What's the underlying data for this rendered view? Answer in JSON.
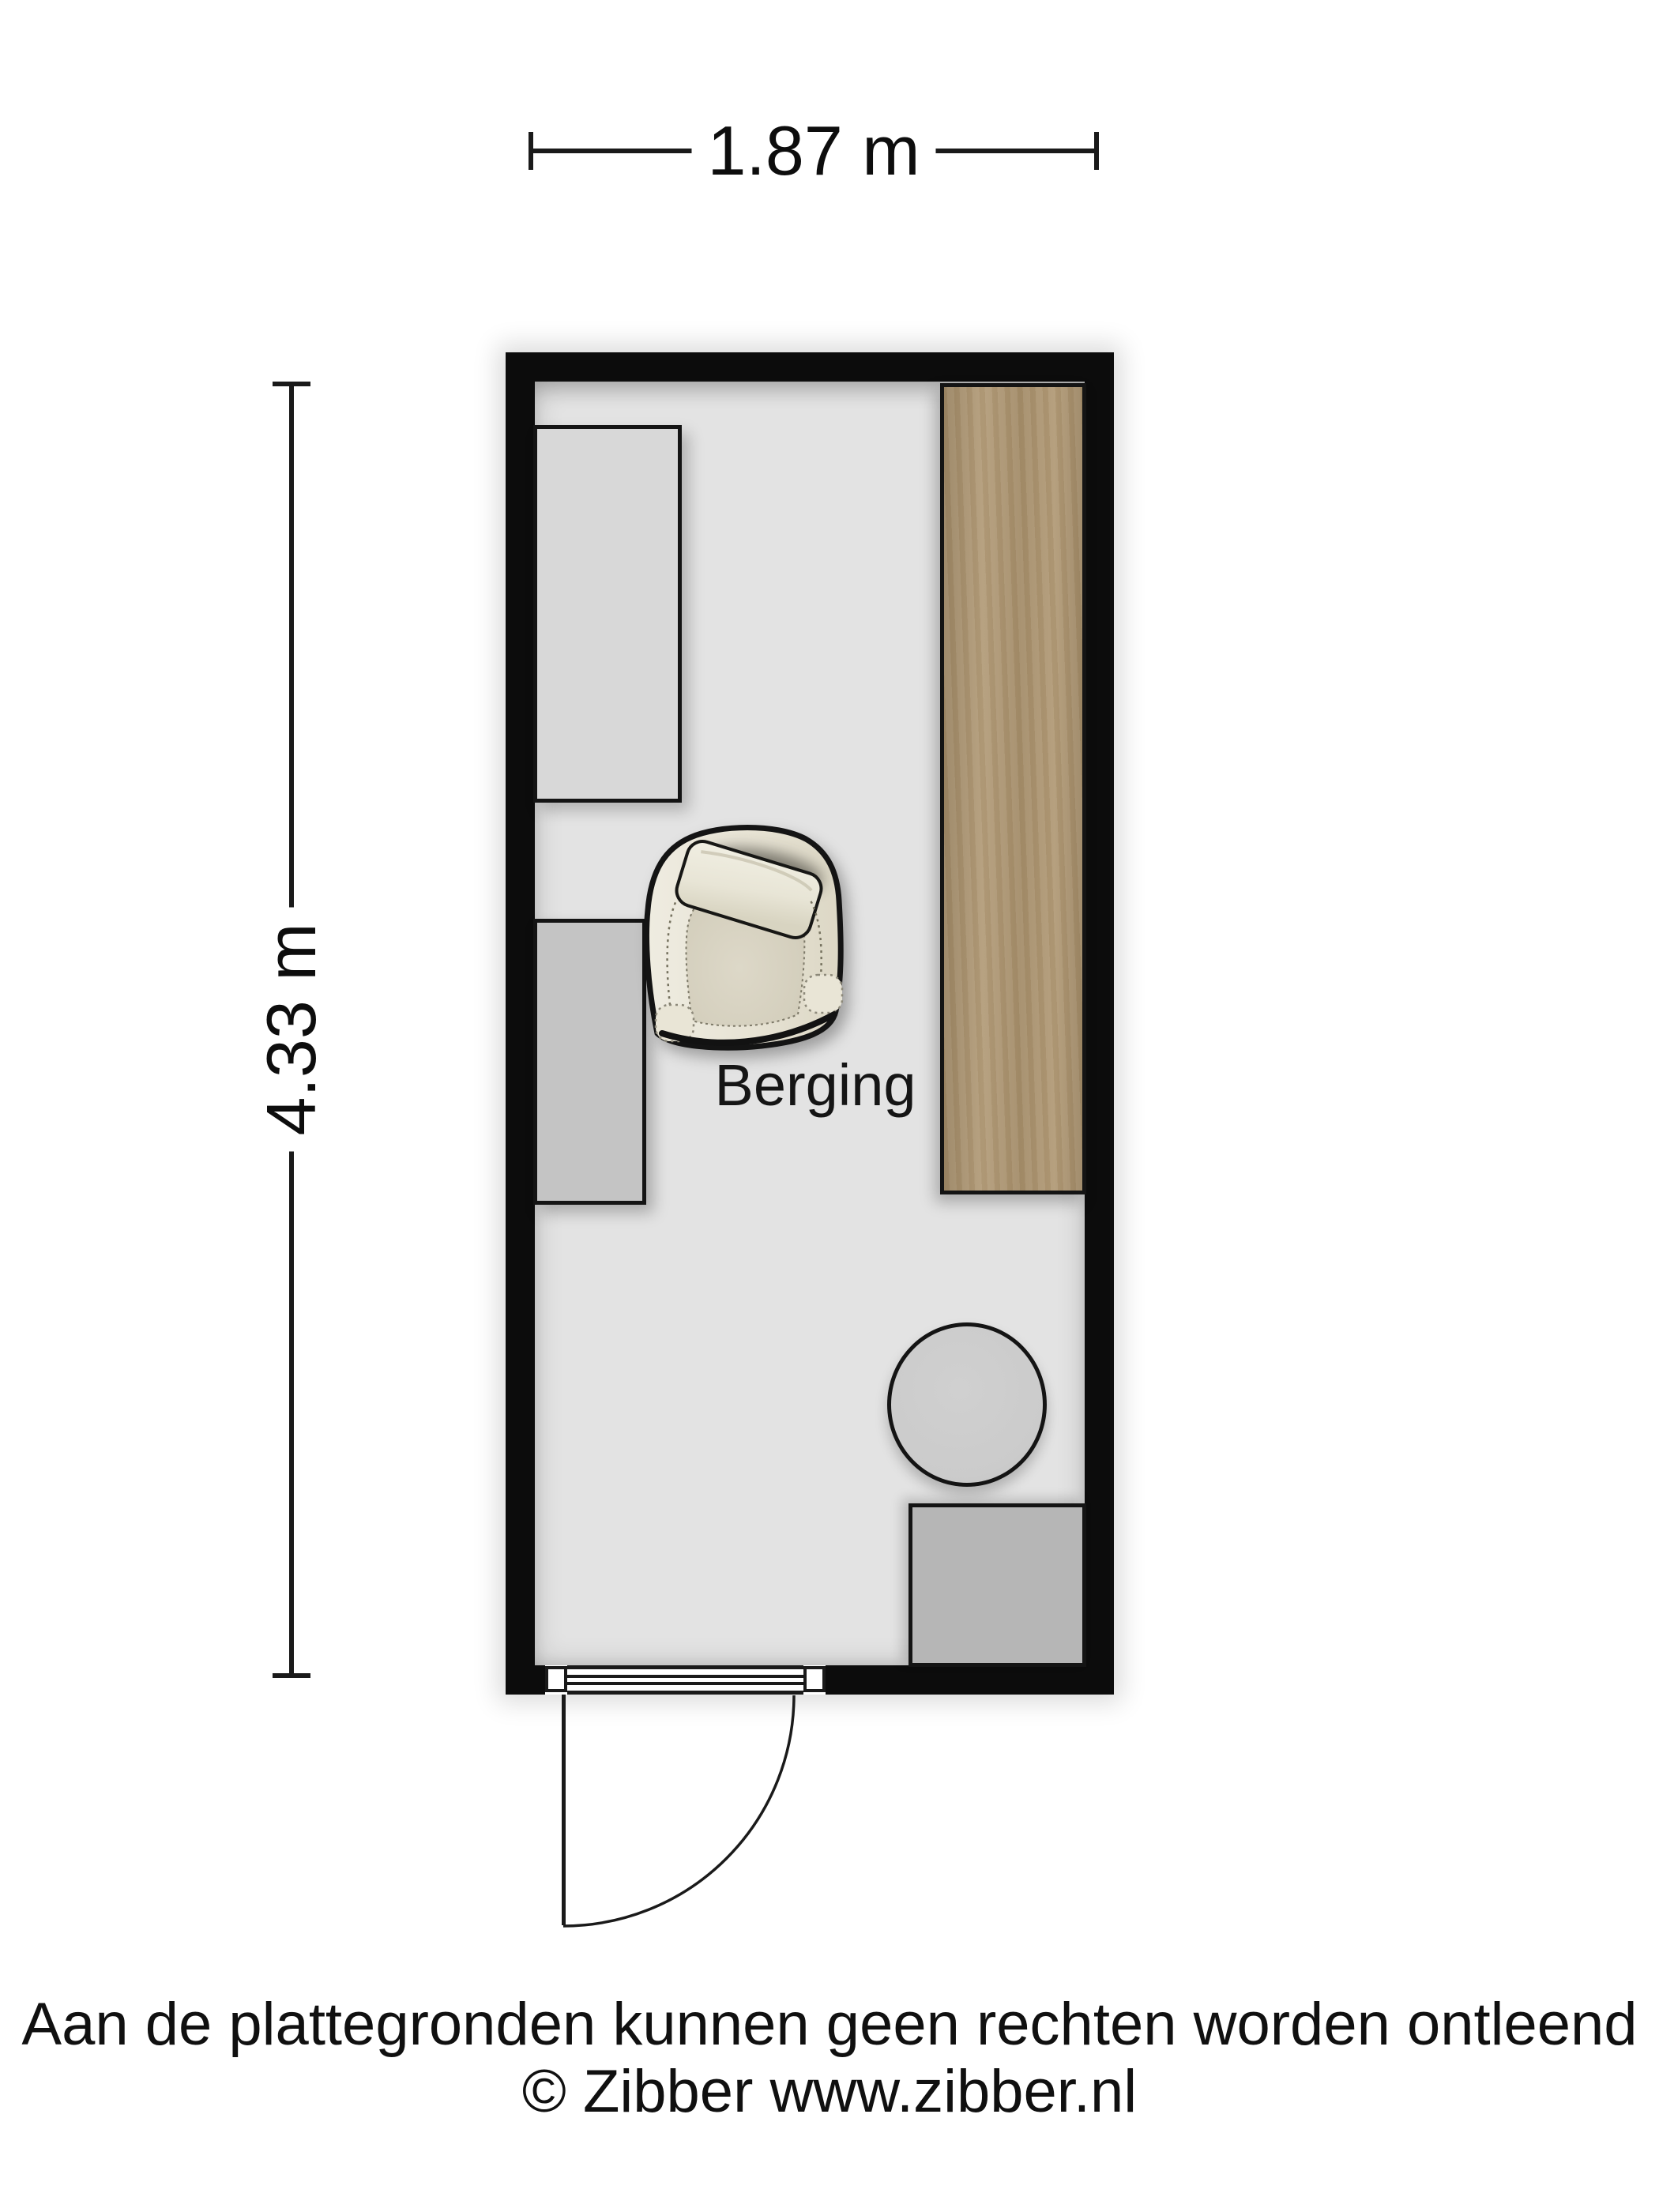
{
  "dimensions": {
    "width_label": "1.87 m",
    "height_label": "4.33 m"
  },
  "room": {
    "label": "Berging"
  },
  "footer": {
    "line1": "Aan de plattegronden kunnen geen rechten worden ontleend",
    "line2": "© Zibber www.zibber.nl"
  },
  "colors": {
    "ink": "#1a1a1a",
    "wall": "#0c0c0c",
    "floor": "#e3e3e3",
    "cabinet": "#d8d8d8",
    "side_table": "#c4c4c4",
    "round_table": "#cbcbcb",
    "storage_box": "#b6b6b6",
    "counter_wood": "#ae9671"
  }
}
